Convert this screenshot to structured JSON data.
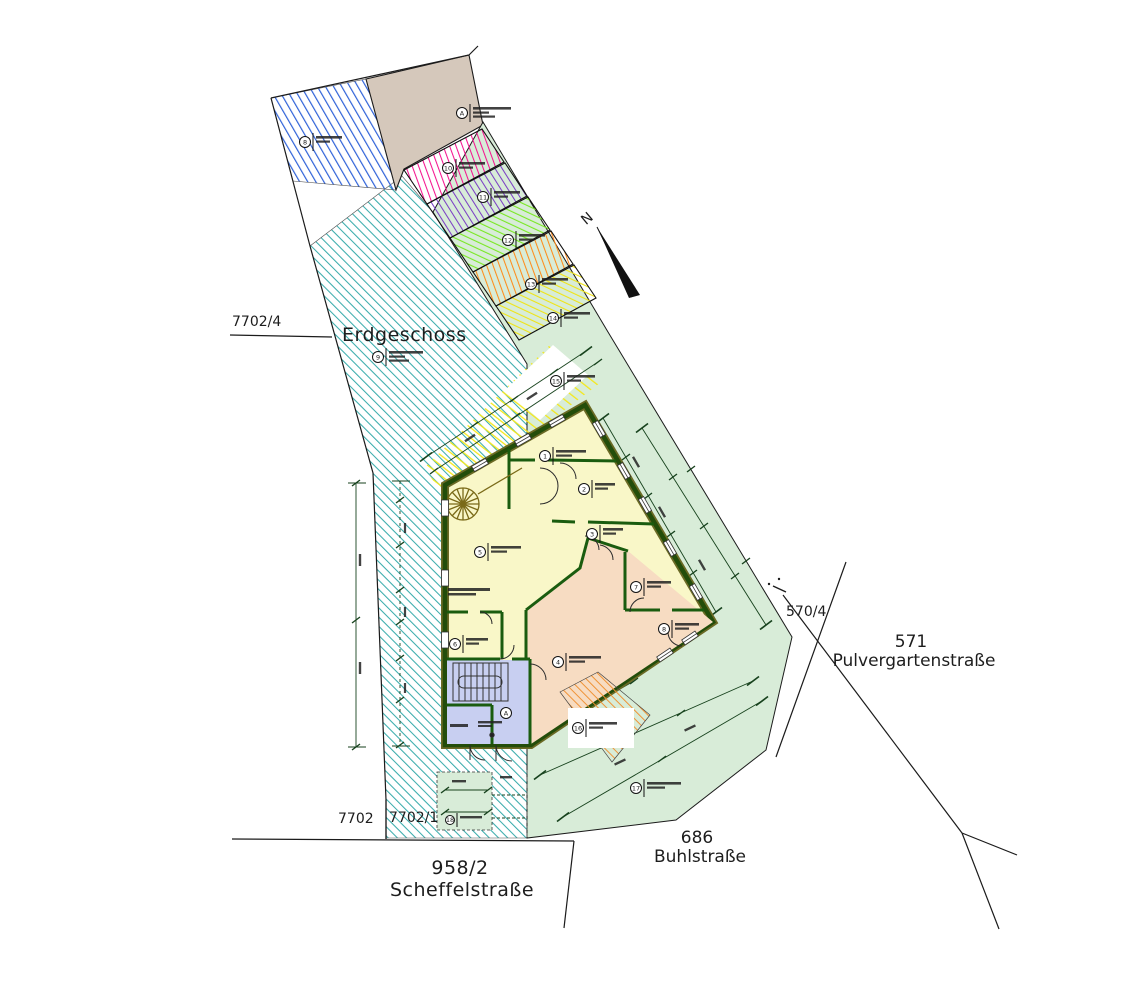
{
  "plan": {
    "floor_title": "Erdgeschoss",
    "north_label": "N",
    "parcels": {
      "p7702_4": "7702/4",
      "p7702": "7702",
      "p7702_1": "7702/1",
      "p958_2": "958/2",
      "p570_4": "570/4",
      "p571": "571",
      "p686": "686"
    },
    "streets": {
      "scheffel": "Scheffelstraße",
      "buhl": "Buhlstraße",
      "pulvergarten": "Pulvergartenstraße"
    },
    "markers": [
      "A",
      "8",
      "9",
      "10",
      "11",
      "12",
      "13",
      "14",
      "15",
      "1",
      "2",
      "3",
      "5",
      "6",
      "7",
      "8",
      "4",
      "A",
      "16",
      "17",
      "18"
    ]
  },
  "colors": {
    "teal_hatch": "#3aacac",
    "blue_hatch": "#2f62d8",
    "brown_fill": "#d5c8bb",
    "pink_hatch": "#f5148f",
    "purple_hatch": "#7b3fc4",
    "green_bay_hatch": "#7ae824",
    "orange_bay_hatch": "#ff8c1a",
    "yellow_bay_hatch": "#f0e416",
    "green_area_fill": "#d8ecd8",
    "room_yellow": "#f9f7c8",
    "room_salmon": "#f7dcc2",
    "room_blue": "#c8cff1",
    "wall_dark_green": "#234d0a",
    "terrace_orange": "#f09030"
  }
}
